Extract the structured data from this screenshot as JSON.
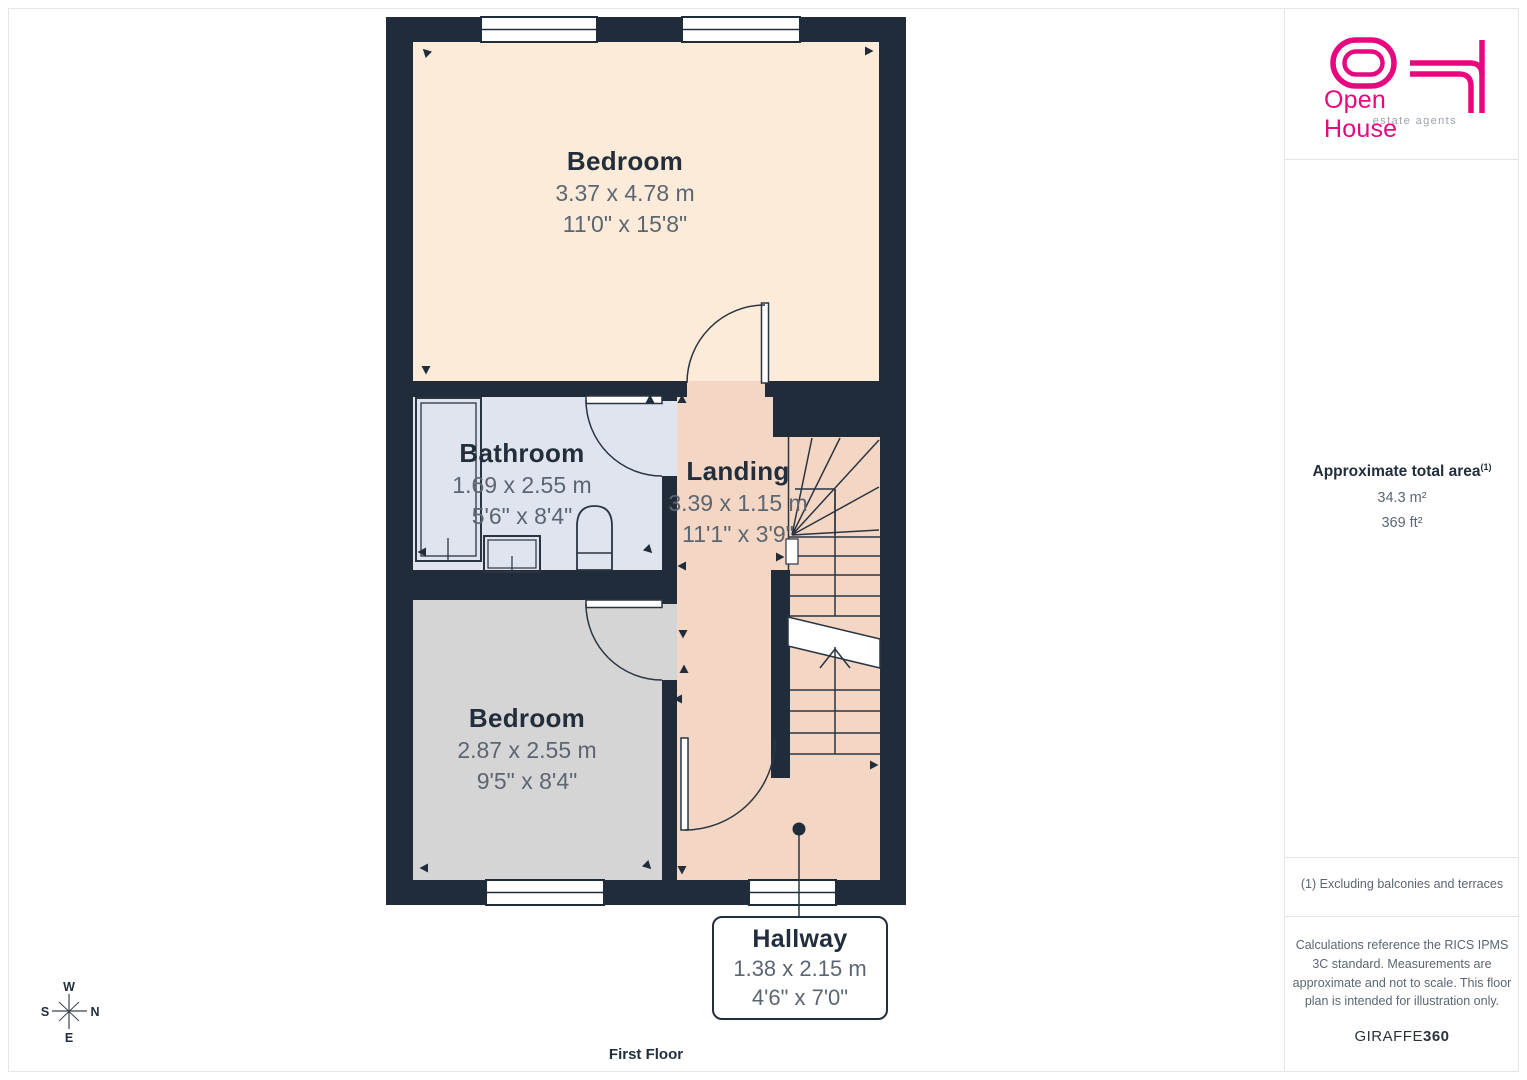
{
  "floor_plan": {
    "floor_label": "First Floor",
    "rooms": [
      {
        "name": "Bedroom",
        "metric": "3.37 x 4.78 m",
        "imperial": "11'0\" x 15'8\""
      },
      {
        "name": "Bathroom",
        "metric": "1.69 x 2.55 m",
        "imperial": "5'6\" x 8'4\""
      },
      {
        "name": "Landing",
        "metric": "3.39 x 1.15 m",
        "imperial": "11'1\" x 3'9\""
      },
      {
        "name": "Bedroom",
        "metric": "2.87 x 2.55 m",
        "imperial": "9'5\" x 8'4\""
      },
      {
        "name": "Hallway",
        "metric": "1.38 x 2.15 m",
        "imperial": "4'6\" x 7'0\""
      }
    ],
    "compass": {
      "n": "N",
      "s": "S",
      "e": "E",
      "w": "W"
    }
  },
  "sidebar": {
    "logo": {
      "brand": "Open House",
      "tagline": "estate agents"
    },
    "area": {
      "title": "Approximate total area",
      "footnote_ref": "(1)",
      "metric": "34.3 m²",
      "imperial": "369 ft²"
    },
    "footnote": "(1) Excluding balconies and terraces",
    "disclaimer": "Calculations reference the RICS IPMS 3C standard. Measurements are approximate and not to scale. This floor plan is intended for illustration only.",
    "brand_name": "GIRAFFE",
    "brand_suffix": "360"
  },
  "colors": {
    "wall": "#212c3a",
    "bedroom_1_floor": "#fcebd9",
    "bathroom_floor": "#dfe4ee",
    "landing_floor": "#f3d6c3",
    "bedroom_2_floor": "#d5d5d6",
    "accent_pink": "#e5087e",
    "dim_text": "#5c6672",
    "label_text": "#232e3c"
  }
}
